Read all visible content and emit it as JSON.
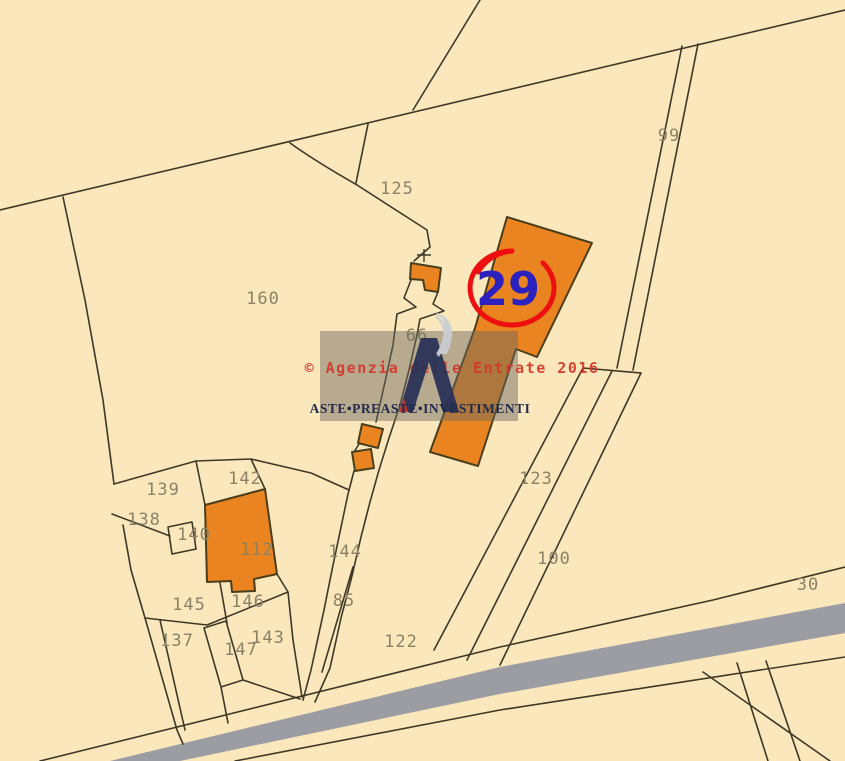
{
  "map": {
    "type": "cadastral-map",
    "parcels": [
      {
        "label": "125"
      },
      {
        "label": "99"
      },
      {
        "label": "160"
      },
      {
        "label": "66"
      },
      {
        "label": "123"
      },
      {
        "label": "100"
      },
      {
        "label": "30"
      },
      {
        "label": "139"
      },
      {
        "label": "138"
      },
      {
        "label": "142"
      },
      {
        "label": "140"
      },
      {
        "label": "112"
      },
      {
        "label": "144"
      },
      {
        "label": "145"
      },
      {
        "label": "146"
      },
      {
        "label": "137"
      },
      {
        "label": "143"
      },
      {
        "label": "147"
      },
      {
        "label": "85"
      },
      {
        "label": "122"
      }
    ],
    "highlight": {
      "circled_number": "29"
    },
    "colors": {
      "background": "#FBE7BC",
      "boundary_line": "#3E3827",
      "building_fill": "#E98420",
      "building_stroke": "#4A3E1C",
      "road_fill": "#9B9DA2",
      "label_text": "#8A8266",
      "highlight_circle": "#EE1010",
      "highlight_number": "#2B21BE",
      "watermark_text": "#D4372A",
      "brand_text": "#1F2A4E"
    }
  },
  "watermark": {
    "copyright": "© Agenzia delle Entrate 2016",
    "brand": "ASTE•PREASTE•INVESTIMENTI"
  }
}
